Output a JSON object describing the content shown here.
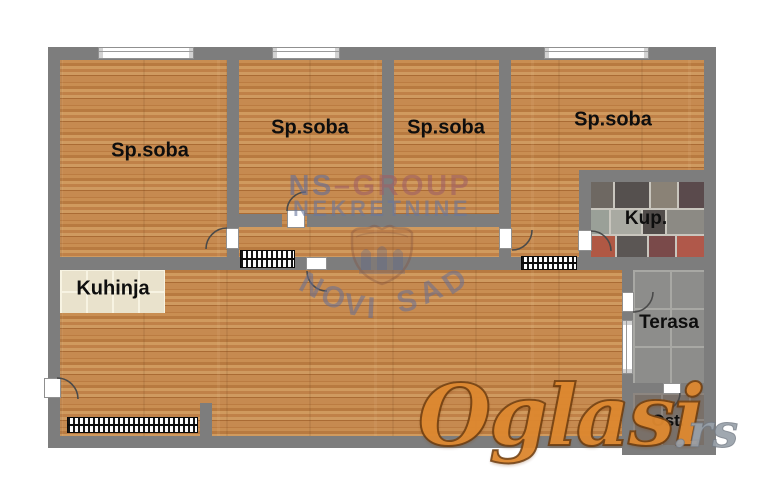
{
  "plan": {
    "rooms": [
      {
        "id": "bedroom-1",
        "label": "Sp.soba"
      },
      {
        "id": "bedroom-2",
        "label": "Sp.soba"
      },
      {
        "id": "bedroom-3",
        "label": "Sp.soba"
      },
      {
        "id": "bedroom-4",
        "label": "Sp.soba"
      },
      {
        "id": "kitchen",
        "label": "Kuhinja"
      },
      {
        "id": "bathroom",
        "label": "Kup."
      },
      {
        "id": "terrace",
        "label": "Terasa"
      },
      {
        "id": "storage",
        "label": "Ost."
      }
    ]
  },
  "watermarks": {
    "agency_line1": "NS–GROUP",
    "agency_line2": "NEKRETNINE",
    "agency_city": "NOVI SAD",
    "portal_name": "Oglasi",
    "portal_suffix": ".rs"
  },
  "colors": {
    "wall_gray": "#7d7d7d",
    "wood_floor": "#c4884e",
    "watermark_blue": "#6b7aa2",
    "watermark_red": "#9e6068",
    "portal_orange": "#dd8830",
    "portal_suffix_gray": "#99a1aa"
  }
}
